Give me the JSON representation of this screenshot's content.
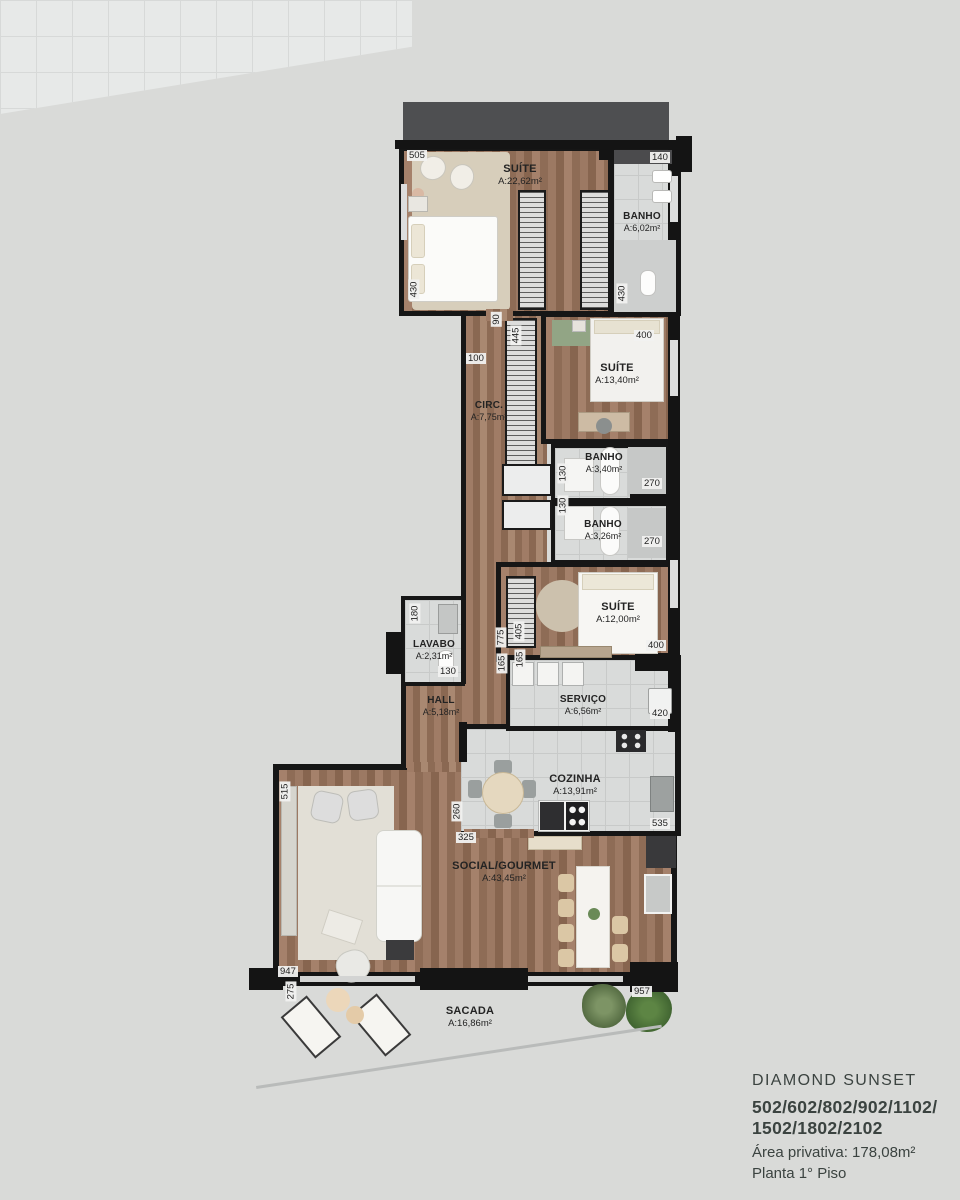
{
  "plan": {
    "rooms": [
      {
        "id": "suite-master",
        "name": "SUÍTE",
        "area": "A:22,62m²"
      },
      {
        "id": "banho-master",
        "name": "BANHO",
        "area": "A:6,02m²"
      },
      {
        "id": "circ",
        "name": "CIRC.",
        "area": "A:7,75m²"
      },
      {
        "id": "suite-2",
        "name": "SUÍTE",
        "area": "A:13,40m²"
      },
      {
        "id": "banho-2",
        "name": "BANHO",
        "area": "A:3,40m²"
      },
      {
        "id": "banho-3",
        "name": "BANHO",
        "area": "A:3,26m²"
      },
      {
        "id": "suite-3",
        "name": "SUÍTE",
        "area": "A:12,00m²"
      },
      {
        "id": "lavabo",
        "name": "LAVABO",
        "area": "A:2,31m²"
      },
      {
        "id": "hall",
        "name": "HALL",
        "area": "A:5,18m²"
      },
      {
        "id": "servico",
        "name": "SERVIÇO",
        "area": "A:6,56m²"
      },
      {
        "id": "cozinha",
        "name": "COZINHA",
        "area": "A:13,91m²"
      },
      {
        "id": "social-gourmet",
        "name": "SOCIAL/GOURMET",
        "area": "A:43,45m²"
      },
      {
        "id": "sacada",
        "name": "SACADA",
        "area": "A:16,86m²"
      }
    ],
    "dims": [
      "505",
      "140",
      "430",
      "430",
      "90",
      "100",
      "445",
      "400",
      "130",
      "270",
      "130",
      "270",
      "405",
      "775",
      "165",
      "165",
      "400",
      "180",
      "130",
      "420",
      "535",
      "260",
      "325",
      "515",
      "947",
      "275",
      "957"
    ]
  },
  "legend": {
    "title": "DIAMOND SUNSET",
    "units_line1": "502/602/802/902/1102/",
    "units_line2": "1502/1802/2102",
    "area": "Área privativa: 178,08m²",
    "floor": "Planta 1° Piso"
  },
  "colors": {
    "wall": "#161616",
    "wood_floor": "#9a7760",
    "tile_floor": "#d9dbda",
    "balcony_floor": "#e7e9e8",
    "rug": "#d7cebb",
    "accent_green": "#92a585",
    "header_band": "#4e4f51",
    "legend_text": "#3b4340",
    "background": "#d9dad8"
  }
}
